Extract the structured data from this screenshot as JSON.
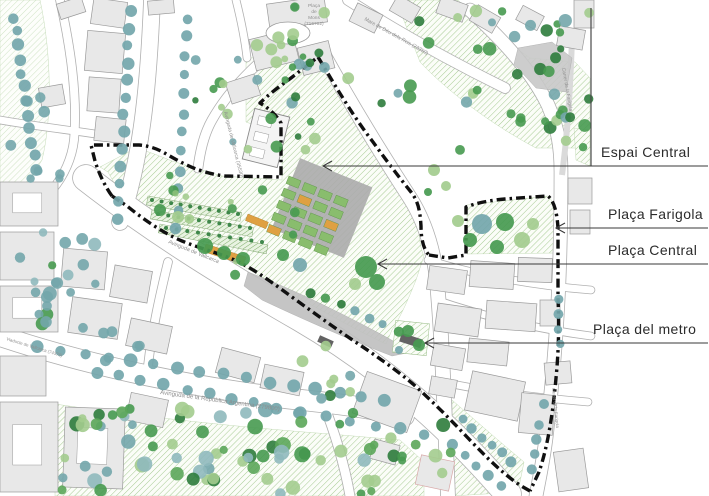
{
  "colors": {
    "background": "#ffffff",
    "building_fill": "#e8e8e8",
    "building_stroke": "#9a9a9a",
    "road_casing": "#b0b0b0",
    "road_fill": "#ffffff",
    "boundary_black": "#101010",
    "hatch_line": "#a6cb93",
    "hatch_bg": "#fbfdf8",
    "hatch_dark_line": "#7cab67",
    "hatch_dark_bg": "#e9f3e2",
    "slope_gray": "#bfbfbf",
    "rock_gray": "#c8c8c8",
    "sidewalk_gray": "#dadada",
    "allotment_green": "#89bd6d",
    "allotment_stroke": "#5c9348",
    "orange_plot": "#dfa042",
    "metro_slab": "#636363",
    "tree_teal": "#73a6ab",
    "tree_green": "#479a50",
    "tree_lightgreen": "#a3cc8e",
    "tree_darkgreen": "#2e7c3c",
    "street_label_gray": "#8f8f8f",
    "callout_text": "#2b2b2b",
    "callout_line": "#3a3a3a",
    "map_edge_line": "#4a4a4a"
  },
  "callouts": [
    {
      "id": "espai-central",
      "label": "Espai Central",
      "text_x": 601,
      "text_y": 157,
      "line_y": 166,
      "tip_x": 323,
      "end_x": 708
    },
    {
      "id": "placa-farigola",
      "label": "Plaça Farigola",
      "text_x": 608,
      "text_y": 219,
      "line_y": 228,
      "tip_x": 556,
      "end_x": 708
    },
    {
      "id": "placa-central",
      "label": "Plaça Central",
      "text_x": 608,
      "text_y": 255,
      "line_y": 264,
      "tip_x": 378,
      "end_x": 708
    },
    {
      "id": "placa-del-metro",
      "label": "Plaça del metro",
      "text_x": 593,
      "text_y": 334,
      "line_y": 343,
      "tip_x": 425,
      "end_x": 708
    }
  ],
  "street_labels": [
    {
      "id": "placa-de-mons",
      "stacked": [
        "Plaça",
        "de",
        "Mons",
        "(716702)"
      ],
      "x": 314,
      "y": 7,
      "size": 4.8
    },
    {
      "id": "mare-de-deu",
      "text": "Mare de Déu dels Reis (23350)",
      "x": 364,
      "y": 20,
      "rot": 29,
      "size": 5.2
    },
    {
      "id": "av-vallcarca-vertical",
      "text": "Avinguda de Vallcarca (35530)",
      "x": 224,
      "y": 112,
      "rot": 76,
      "size": 5
    },
    {
      "id": "av-vallcarca-diagonal",
      "text": "Avinguda de Vallcarca",
      "x": 168,
      "y": 243,
      "rot": 22,
      "size": 5.5
    },
    {
      "id": "av-republica-argentina",
      "text": "Avinguda de la República Argentina (279800)",
      "x": 160,
      "y": 394,
      "rot": 8,
      "size": 6
    },
    {
      "id": "carrer-farigola",
      "text": "Carrer de la Farigola",
      "x": 562,
      "y": 68,
      "rot": 80,
      "size": 4.8
    },
    {
      "id": "carrer-farigola-sud",
      "text": "Carrer de la Farigola",
      "x": 552,
      "y": 388,
      "rot": 84,
      "size": 4.4
    },
    {
      "id": "viaducte-vallcarca",
      "text": "Viaducte de Vallcarca (74376)",
      "x": 6,
      "y": 340,
      "rot": 17,
      "size": 4.4
    }
  ],
  "map": {
    "edge_line": {
      "x": 591,
      "y1": 8,
      "y2": 166
    },
    "roads": [
      {
        "d": "M 86,178 C 150,228 220,272 300,318 C 372,360 440,415 508,494",
        "w": 26
      },
      {
        "d": "M 0,336 C 90,366 200,390 320,402 C 355,406 382,410 404,416",
        "w": 20
      },
      {
        "d": "M 152,0 C 149,75 143,155 120,222",
        "w": 16
      },
      {
        "d": "M 286,40 C 258,62 230,88 212,120 C 204,134 200,152 198,168",
        "w": 9
      },
      {
        "d": "M 322,52 C 352,106 384,158 410,198 C 424,220 432,246 436,272 C 442,330 444,400 448,496",
        "w": 14
      },
      {
        "d": "M 470,10 C 505,42 532,72 548,105 C 558,128 561,148 561,172 C 561,250 559,330 546,438 C 543,462 539,480 536,496",
        "w": 13
      },
      {
        "d": "M 348,0 C 398,32 452,62 505,88",
        "w": 10
      },
      {
        "d": "M 428,260 C 478,276 540,286 591,290",
        "w": 7
      },
      {
        "d": "M 436,300 C 488,318 544,330 591,336",
        "w": 7
      },
      {
        "d": "M 452,384 C 492,392 540,398 588,402",
        "w": 7
      },
      {
        "d": "M 0,120 C 45,128 90,132 118,138",
        "w": 7
      },
      {
        "d": "M 60,0 C 70,45 78,95 74,140 C 72,158 64,176 52,190",
        "w": 8
      },
      {
        "d": "M 168,262 C 160,295 152,330 148,366",
        "w": 8
      },
      {
        "d": "M 322,400 C 334,430 344,462 350,496",
        "w": 9
      },
      {
        "d": "M 236,0 C 241,20 245,40 247,58",
        "w": 7
      }
    ],
    "greens": [
      {
        "d": "M0,0 L40,0 C52,55 52,120 42,160 L20,195 L0,198 Z",
        "light": true
      },
      {
        "d": "M246,58 L320,56 L398,168 L330,152 L246,122 Z"
      },
      {
        "d": "M396,0 L458,0 C480,22 505,40 530,58 L575,62 L590,78 L590,148 L536,148 C498,128 452,96 420,62 Z"
      },
      {
        "d": "M574,128 L590,130 L590,166 L576,160 Z"
      },
      {
        "d": "M100,167 L136,148 C150,152 162,157 172,161 L222,176 L282,180 L282,128 L264,106 L293,82 L318,60 C332,84 352,114 374,144 L408,193 C415,202 418,212 419,227 C419,240 421,250 424,256 L416,280 C408,300 400,318 392,330 L386,344 C360,332 330,315 302,300 C270,282 248,268 230,260 C210,252 196,249 180,242 C162,234 143,220 128,208 L108,172 Z"
      },
      {
        "d": "M467,205 L548,196 C554,202 557,212 557,228 L557,253 L467,254 Z"
      },
      {
        "d": "M55,404 C150,418 250,428 330,434 L400,440 L424,462 L424,496 L55,496 Z"
      },
      {
        "d": "M452,400 C475,420 500,442 524,462 L518,492 L452,496 Z"
      }
    ],
    "metro_square": {
      "x": 394,
      "y": 322,
      "w": 34,
      "h": 32,
      "rot": 6
    },
    "metro_slabs": [
      [
        400,
        336,
        22,
        9,
        18
      ],
      [
        318,
        338,
        15,
        7,
        24
      ]
    ],
    "slopes": [
      "M248,272 C290,288 340,312 388,338 L412,352 L392,356 C350,340 300,318 262,300 L244,286 Z",
      "M518,48 L552,42 L572,58 L566,92 L536,88 L514,64 Z"
    ],
    "sidewalk": {
      "d": "M 572,40 C 570,90 568,130 562,175",
      "w": 6
    },
    "plaza_ellipse": {
      "cx": 288,
      "cy": 33,
      "rx": 22,
      "ry": 11
    },
    "school": {
      "x": 248,
      "y": 112,
      "w": 36,
      "h": 52,
      "rot": 14
    },
    "buildings": [
      [
        92,
        0,
        34,
        26,
        8
      ],
      [
        86,
        32,
        38,
        40,
        5
      ],
      [
        88,
        78,
        32,
        34,
        4
      ],
      [
        58,
        0,
        26,
        16,
        -18
      ],
      [
        148,
        0,
        26,
        14,
        -5
      ],
      [
        268,
        0,
        58,
        26,
        -8
      ],
      [
        252,
        34,
        44,
        32,
        -14
      ],
      [
        300,
        44,
        32,
        28,
        -14
      ],
      [
        228,
        78,
        30,
        22,
        -18
      ],
      [
        352,
        8,
        28,
        20,
        26
      ],
      [
        392,
        0,
        26,
        18,
        30
      ],
      [
        438,
        0,
        28,
        18,
        20
      ],
      [
        472,
        10,
        26,
        18,
        30
      ],
      [
        574,
        0,
        20,
        28,
        0
      ],
      [
        558,
        28,
        26,
        20,
        10
      ],
      [
        518,
        10,
        24,
        16,
        28
      ],
      [
        0,
        182,
        58,
        44,
        0,
        "court"
      ],
      [
        0,
        232,
        54,
        48,
        0
      ],
      [
        0,
        286,
        58,
        46,
        0,
        "court"
      ],
      [
        62,
        250,
        44,
        38,
        5
      ],
      [
        70,
        300,
        50,
        36,
        8
      ],
      [
        112,
        268,
        38,
        32,
        10
      ],
      [
        128,
        322,
        42,
        28,
        12
      ],
      [
        0,
        356,
        46,
        40,
        0
      ],
      [
        0,
        402,
        58,
        90,
        0,
        "court"
      ],
      [
        64,
        408,
        60,
        80,
        2,
        "court"
      ],
      [
        128,
        396,
        38,
        28,
        12
      ],
      [
        218,
        352,
        40,
        26,
        15
      ],
      [
        262,
        368,
        40,
        24,
        12
      ],
      [
        358,
        380,
        58,
        44,
        20
      ],
      [
        428,
        268,
        38,
        24,
        8
      ],
      [
        470,
        262,
        44,
        26,
        4
      ],
      [
        518,
        258,
        34,
        24,
        2
      ],
      [
        436,
        306,
        44,
        28,
        8
      ],
      [
        486,
        302,
        50,
        28,
        4
      ],
      [
        540,
        300,
        20,
        26,
        0
      ],
      [
        432,
        346,
        32,
        22,
        10
      ],
      [
        468,
        340,
        40,
        24,
        6
      ],
      [
        468,
        376,
        54,
        40,
        12
      ],
      [
        520,
        394,
        34,
        40,
        5
      ],
      [
        430,
        378,
        26,
        18,
        10
      ],
      [
        418,
        458,
        34,
        30,
        12,
        "pink"
      ],
      [
        372,
        442,
        26,
        20,
        15
      ],
      [
        568,
        178,
        24,
        26,
        0
      ],
      [
        570,
        210,
        20,
        24,
        0
      ],
      [
        545,
        362,
        26,
        22,
        -5
      ],
      [
        556,
        450,
        30,
        40,
        -8
      ],
      [
        95,
        118,
        30,
        24,
        6
      ],
      [
        40,
        86,
        24,
        20,
        -10
      ]
    ],
    "gardens": {
      "base": {
        "x": 283,
        "y": 170,
        "w": 78,
        "h": 76,
        "rot": 22
      },
      "grid": {
        "ox": 289,
        "oy": 176,
        "rot": 22,
        "cols": 4,
        "rows": 5,
        "cw": 17,
        "ch": 13,
        "w": 13,
        "h": 8,
        "orange": [
          [
            1,
            1
          ],
          [
            3,
            2
          ],
          [
            0,
            4
          ]
        ]
      },
      "strips": [
        [
          148,
          196,
          95,
          9,
          10
        ],
        [
          152,
          210,
          103,
          9,
          10
        ],
        [
          160,
          224,
          110,
          9,
          11
        ]
      ],
      "orange_strips": [
        [
          206,
          244,
          42,
          8,
          18
        ],
        [
          248,
          214,
          22,
          7,
          22
        ]
      ],
      "dot_rows": [
        [
          152,
          200,
          238,
          214,
          10
        ],
        [
          158,
          214,
          250,
          228,
          10
        ],
        [
          166,
          228,
          262,
          242,
          10
        ]
      ]
    },
    "boundary_paths": [
      "M112,196 C106,188 99,174 95,161 L91,145 L139,145 C151,146 160,150 168,155 C180,162 190,167 199,170 C208,173 216,175 225,176 L281,177 L281,123 C277,116 270,109 260,103 C268,95 280,86 291,78 L318,57",
      "M318,57 C332,80 350,112 373,142 C383,156 398,176 411,192 C418,201 420,210 421,226 C421,240 424,250 429,255",
      "M429,255 L448,258 L466,255 L466,207 C476,203 492,200 505,199 L548,196 C554,201 557,212 558,228 L558,298 C559,322 559,348 556,378 C553,412 548,446 539,472 L530,491",
      "M530,491 L523,487 C505,476 487,458 467,437 C449,418 431,400 413,384 C395,369 375,355 354,341 C329,324 303,305 281,289 C263,276 247,265 232,259 C215,252 199,248 182,241 C163,233 143,219 127,206 L112,196"
    ],
    "tree_rows": [
      [
        14,
        18,
        36,
        170,
        12,
        5.5,
        "teal"
      ],
      [
        130,
        12,
        118,
        218,
        13,
        5.5,
        "teal"
      ],
      [
        188,
        18,
        176,
        228,
        12,
        5,
        "teal"
      ],
      [
        38,
        346,
        385,
        400,
        16,
        6,
        "teal"
      ],
      [
        96,
        372,
        300,
        412,
        10,
        5.5,
        "teal"
      ],
      [
        300,
        412,
        425,
        434,
        6,
        5.5,
        "teal"
      ],
      [
        312,
        292,
        398,
        332,
        7,
        4.5,
        "mix"
      ],
      [
        462,
        420,
        512,
        462,
        6,
        5,
        "teal"
      ],
      [
        452,
        445,
        500,
        485,
        5,
        5,
        "teal"
      ],
      [
        540,
        425,
        533,
        468,
        4,
        5,
        "teal"
      ],
      [
        560,
        300,
        559,
        345,
        4,
        4.5,
        "teal"
      ]
    ],
    "tree_scatters": [
      [
        0,
        230,
        112,
        100,
        22,
        4,
        7,
        "tealmix",
        11
      ],
      [
        195,
        55,
        145,
        105,
        16,
        3,
        6,
        "mix",
        22
      ],
      [
        232,
        0,
        110,
        55,
        10,
        3.5,
        6.5,
        "mix",
        33
      ],
      [
        390,
        0,
        200,
        150,
        34,
        3.5,
        7,
        "greenmix",
        44
      ],
      [
        248,
        60,
        150,
        90,
        14,
        3,
        7,
        "mix",
        55
      ],
      [
        148,
        175,
        150,
        100,
        12,
        3,
        6,
        "lightmix",
        66
      ],
      [
        60,
        408,
        300,
        88,
        62,
        4,
        8,
        "full",
        77
      ],
      [
        350,
        425,
        110,
        70,
        16,
        4,
        7,
        "full",
        88
      ],
      [
        545,
        60,
        45,
        75,
        8,
        4,
        6.5,
        "mix",
        99
      ],
      [
        0,
        90,
        60,
        110,
        8,
        4,
        6,
        "teal",
        111
      ],
      [
        95,
        330,
        60,
        40,
        5,
        4,
        6,
        "teal",
        122
      ],
      [
        290,
        345,
        70,
        55,
        8,
        4,
        6,
        "mix",
        133
      ]
    ],
    "tree_singles": [
      [
        482,
        224,
        10,
        "teal"
      ],
      [
        505,
        222,
        9,
        "green"
      ],
      [
        470,
        240,
        7,
        "green"
      ],
      [
        522,
        240,
        8,
        "lightgreen"
      ],
      [
        497,
        247,
        7,
        "green"
      ],
      [
        533,
        224,
        6,
        "lightgreen"
      ],
      [
        458,
        221,
        6,
        "lightgreen"
      ],
      [
        366,
        267,
        11,
        "green"
      ],
      [
        377,
        282,
        8,
        "green"
      ],
      [
        355,
        284,
        6,
        "lightgreen"
      ],
      [
        408,
        331,
        6,
        "green"
      ],
      [
        419,
        345,
        6,
        "green"
      ],
      [
        399,
        350,
        4,
        "teal"
      ],
      [
        205,
        246,
        8,
        "green"
      ],
      [
        224,
        253,
        7,
        "green"
      ],
      [
        243,
        259,
        7,
        "green"
      ],
      [
        160,
        210,
        6,
        "green"
      ],
      [
        178,
        217,
        6,
        "lightgreen"
      ],
      [
        434,
        170,
        6,
        "lightgreen"
      ],
      [
        446,
        186,
        5,
        "lightgreen"
      ],
      [
        428,
        192,
        4,
        "green"
      ],
      [
        544,
        404,
        5,
        "teal"
      ],
      [
        300,
        265,
        7,
        "teal"
      ],
      [
        283,
        255,
        6,
        "green"
      ]
    ],
    "palettes": {
      "teal": [
        "#73a6ab"
      ],
      "green": [
        "#479a50"
      ],
      "lightgreen": [
        "#a3cc8e"
      ],
      "darkgreen": [
        "#2e7c3c"
      ],
      "tealmix": [
        "#73a6ab",
        "#73a6ab",
        "#73a6ab",
        "#479a50",
        "#8fb9bd"
      ],
      "mix": [
        "#479a50",
        "#73a6ab",
        "#a3cc8e",
        "#2e7c3c"
      ],
      "greenmix": [
        "#479a50",
        "#2e7c3c",
        "#a3cc8e",
        "#73a6ab",
        "#479a50"
      ],
      "lightmix": [
        "#a3cc8e",
        "#8cc07a",
        "#479a50"
      ],
      "full": [
        "#73a6ab",
        "#479a50",
        "#a3cc8e",
        "#2e7c3c",
        "#8fb9bd",
        "#5ba659"
      ]
    }
  }
}
